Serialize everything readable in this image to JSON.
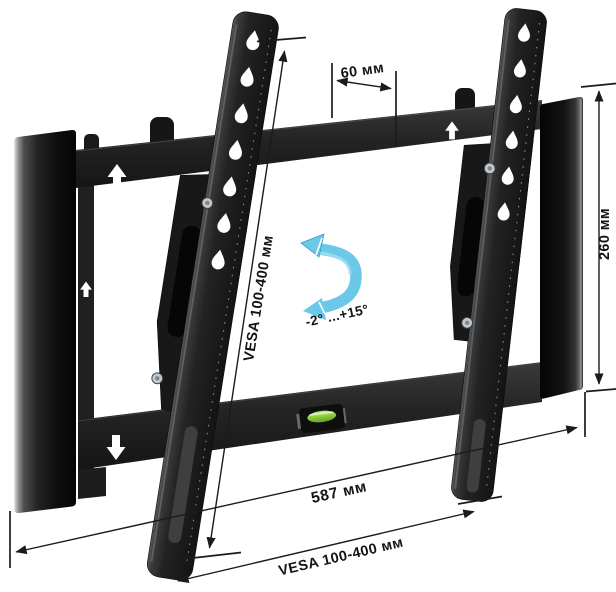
{
  "figure": {
    "description": "Tilting TV wall mount bracket shown in perspective with dimension annotations",
    "background_color": "#ffffff"
  },
  "colors": {
    "dimension_line": "#1b1b1b",
    "label_text": "#141414",
    "metal_dark": "#1a1a1a",
    "metal_edge_highlight": "#787878",
    "tilt_arrow_fill": "#6bc8e8",
    "tilt_arrow_highlight": "#a8e0f2",
    "tilt_arrow_stroke": "#2e9fc6",
    "level_green": "#8ccb3c"
  },
  "annotations": {
    "top_width": {
      "label": "60 мм"
    },
    "right_height": {
      "label": "260 мм"
    },
    "bottom_width": {
      "label": "587 мм"
    },
    "vesa_diagonal": {
      "label": "VESA 100-400 мм"
    },
    "vesa_bottom": {
      "label": "VESA 100-400 мм"
    },
    "tilt_range": {
      "label": "-2° ...+15°"
    }
  }
}
